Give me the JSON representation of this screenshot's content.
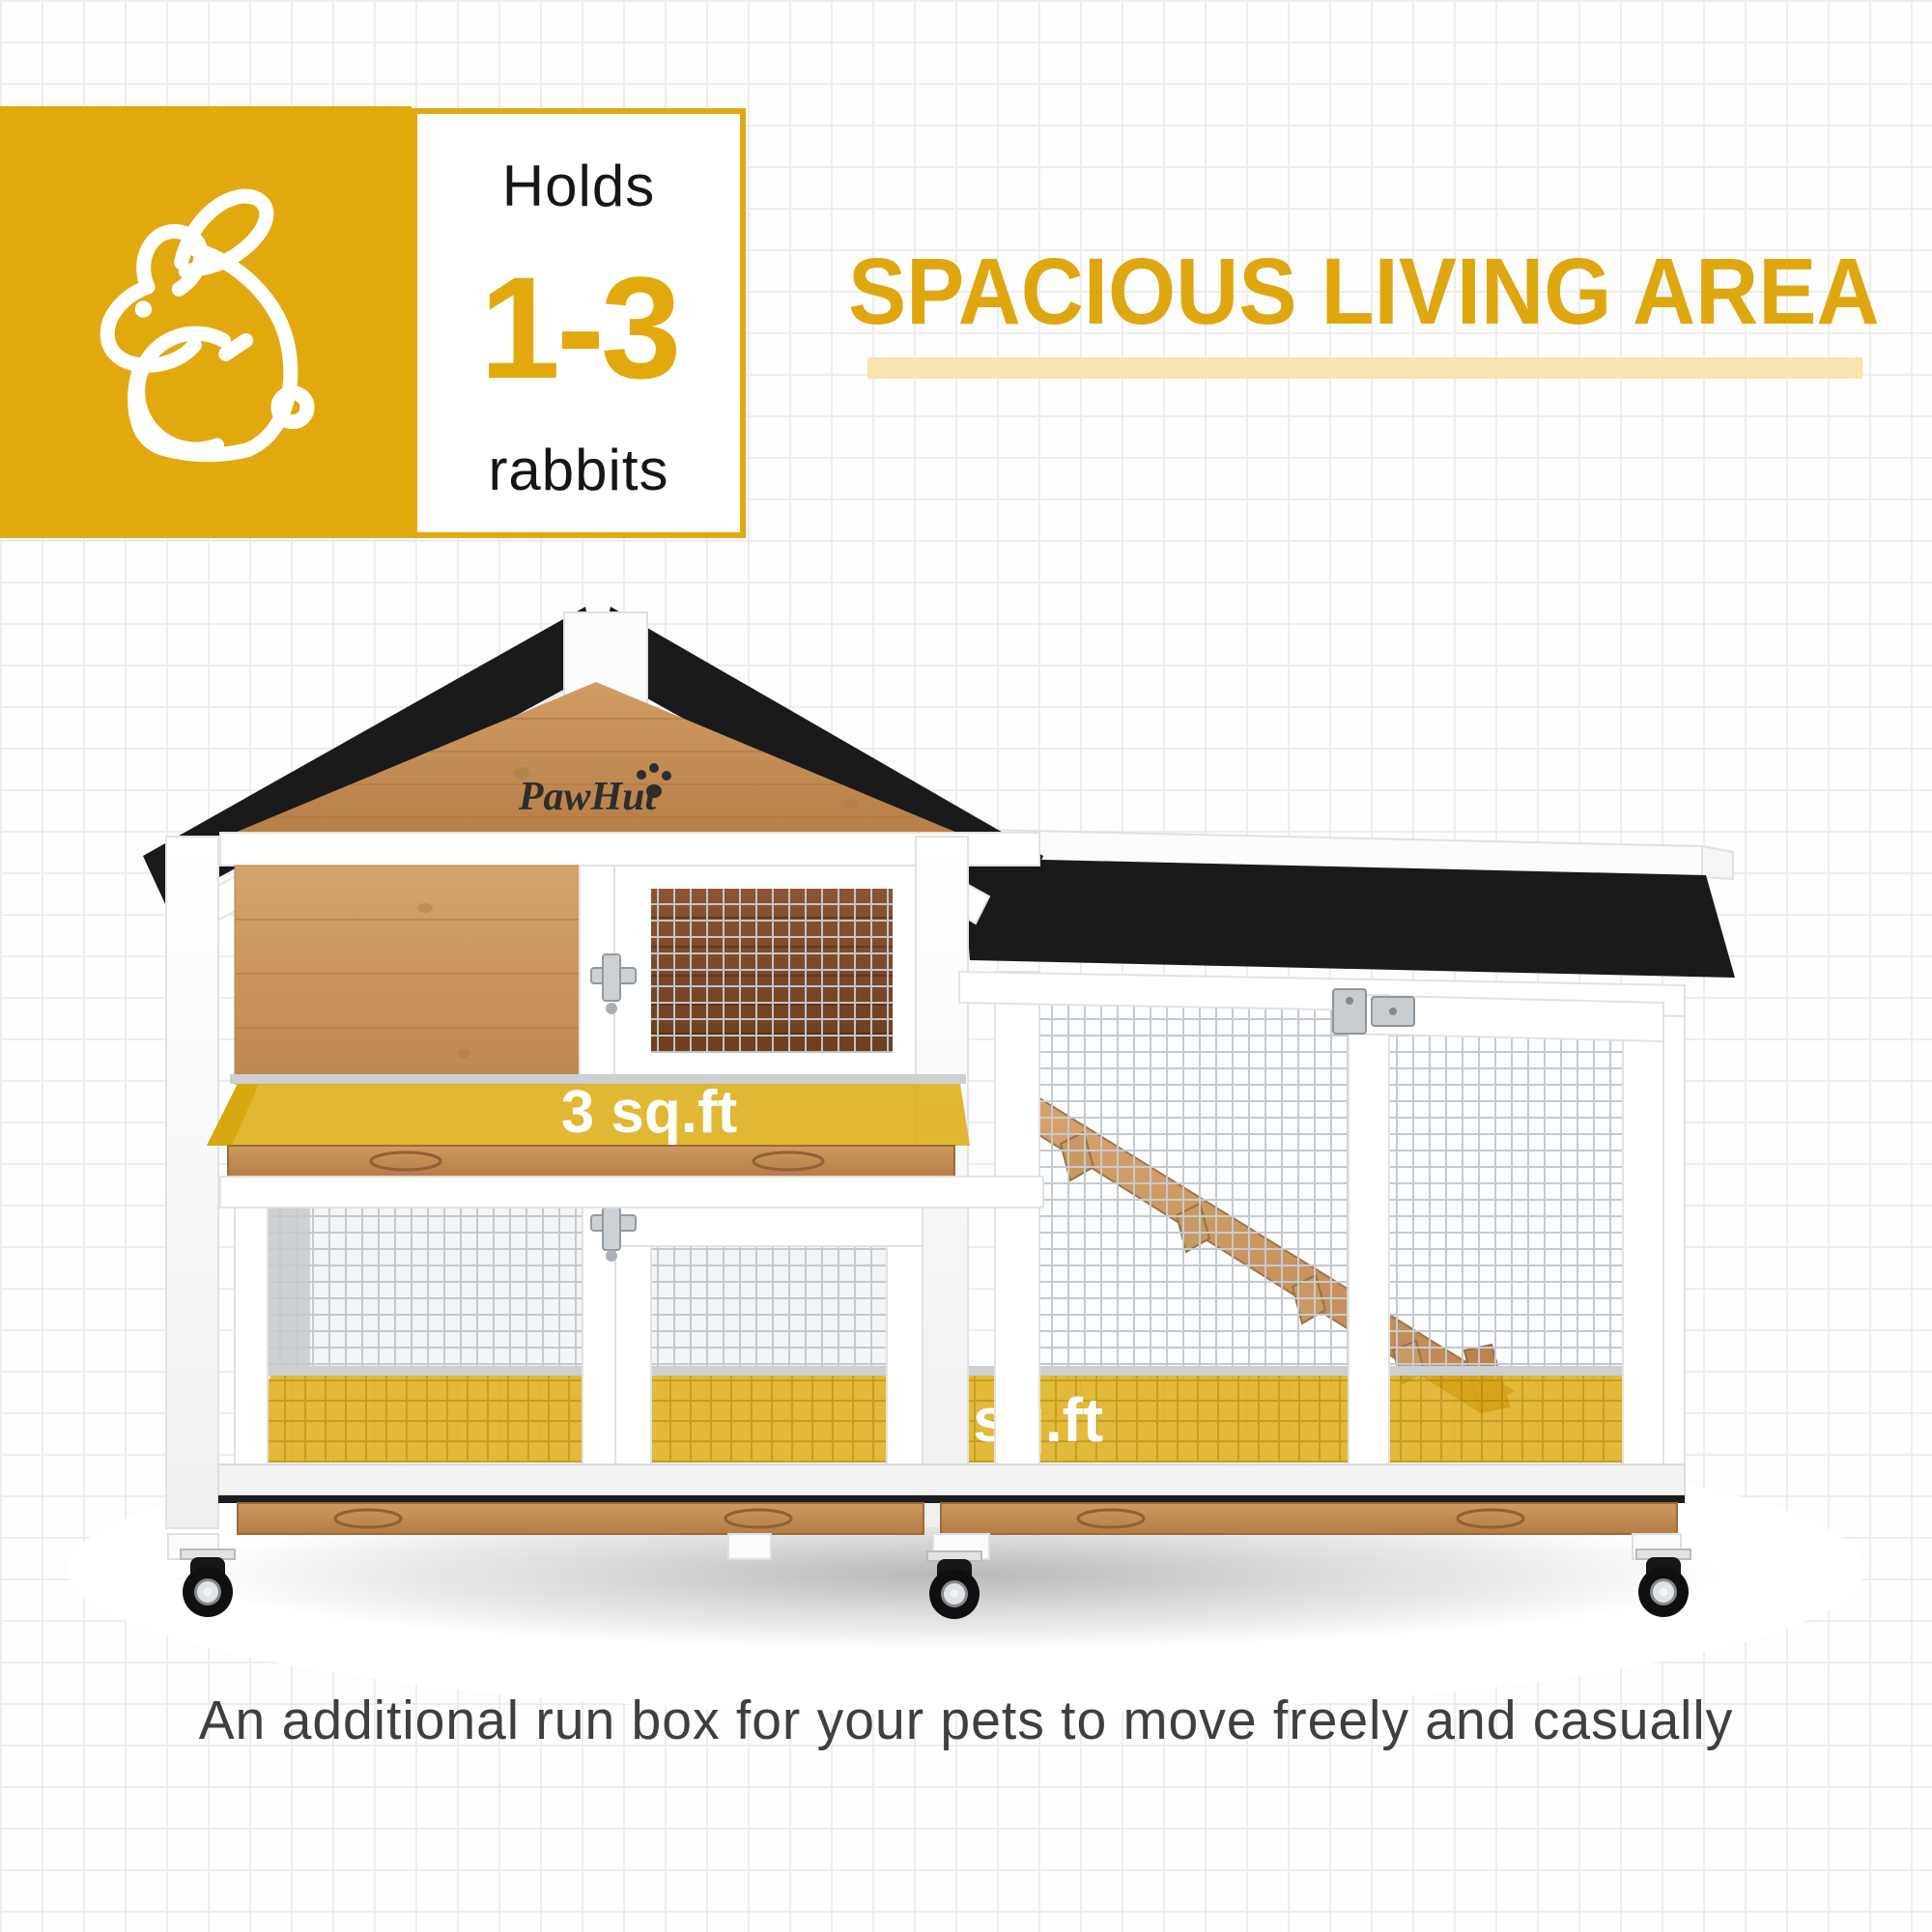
{
  "badge": {
    "holds": "Holds",
    "range": "1-3",
    "animal": "rabbits"
  },
  "heading": {
    "title": "SPACIOUS LIVING AREA"
  },
  "product": {
    "brand": "PawHut",
    "upper_area_label": "3 sq.ft",
    "run_area_label": "6 sq.ft"
  },
  "caption": "An additional run box for your pets to move freely and casually",
  "colors": {
    "accent_gold": "#E2A90F",
    "heading_gold": "#DFA70F",
    "underline_pale_gold": "#F6E3AD",
    "overlay_gold": "#DCAC12",
    "roof_black": "#1a1a1a",
    "wood_brown": "#C99058",
    "caption_gray": "#3F3F3F"
  }
}
